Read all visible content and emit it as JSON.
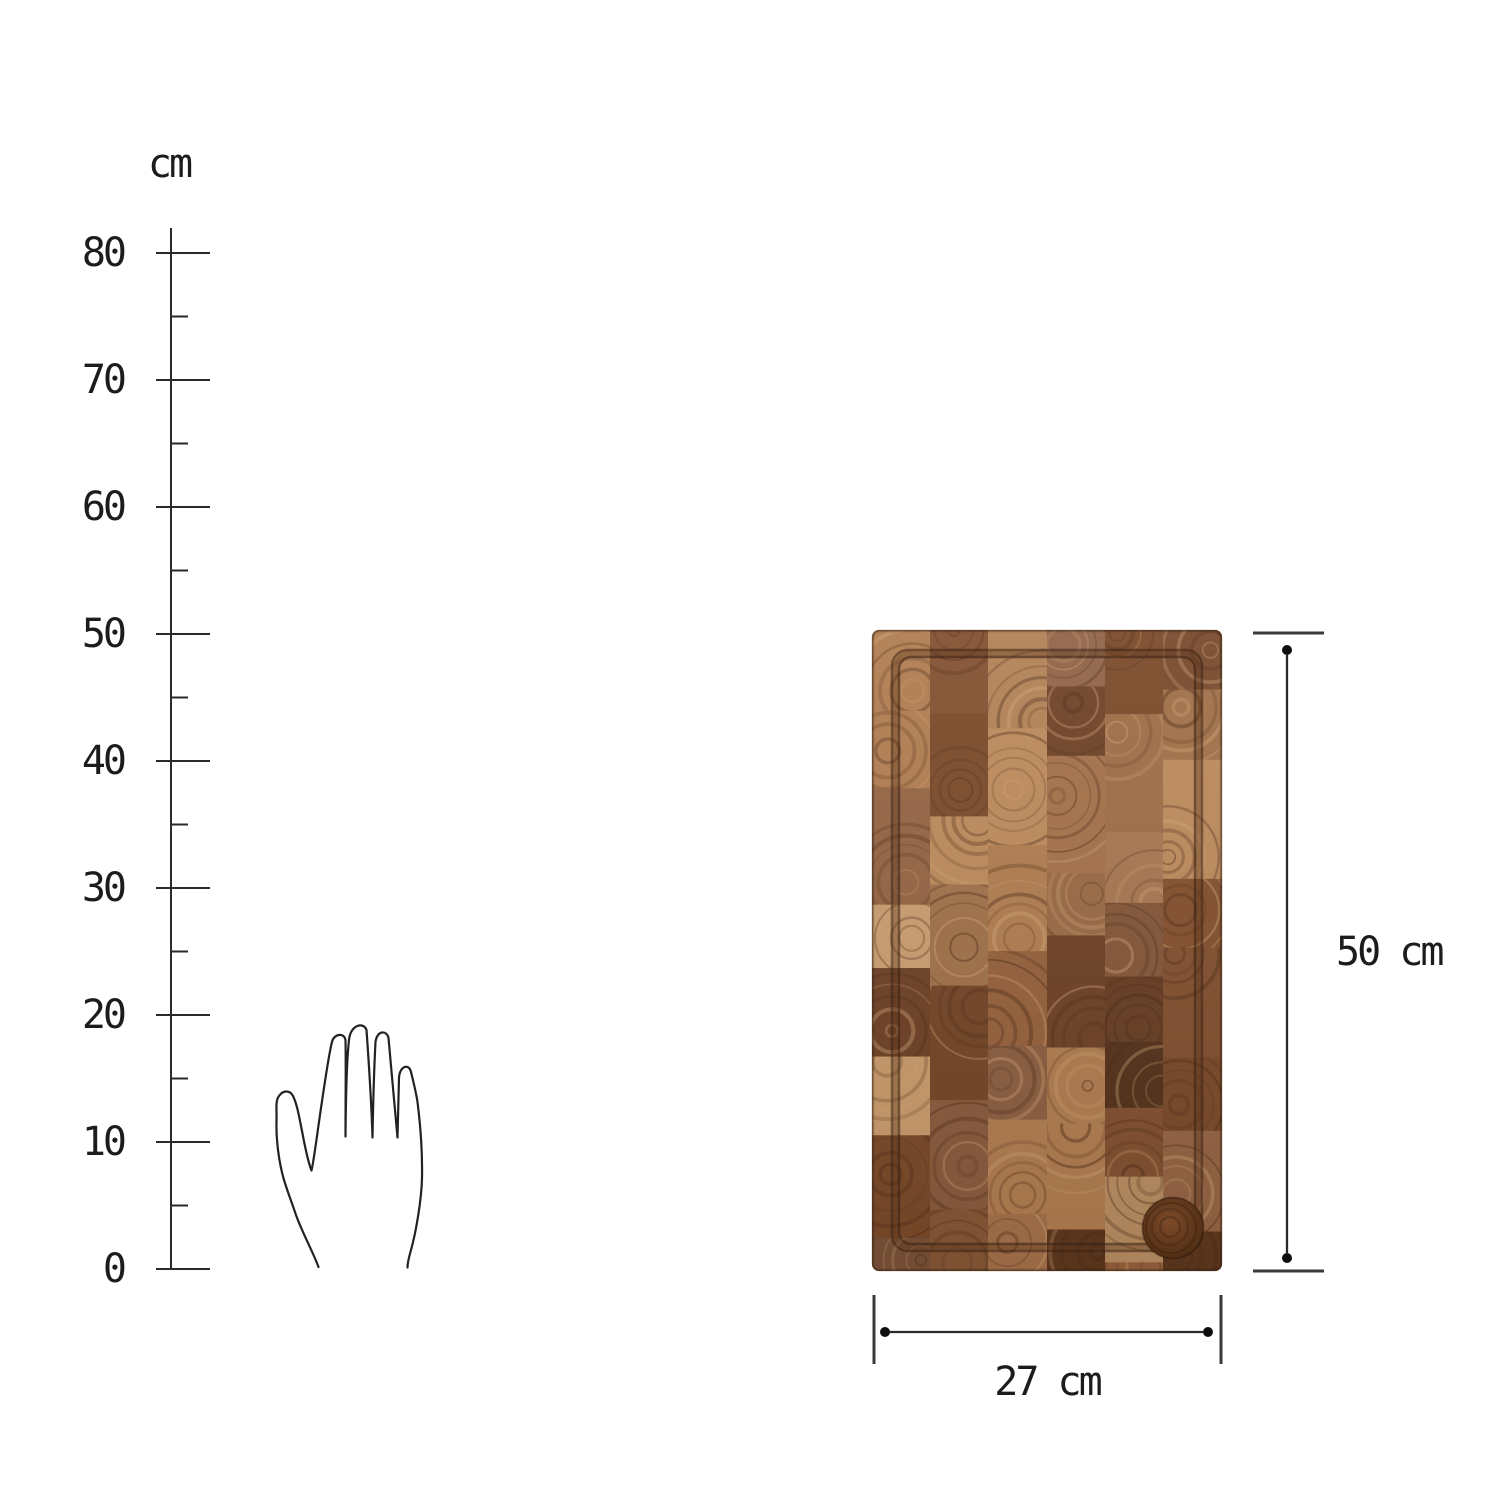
{
  "ruler": {
    "unit_label": "cm",
    "tick_labels": [
      "80",
      "70",
      "60",
      "50",
      "40",
      "30",
      "20",
      "10",
      "0"
    ]
  },
  "annotations": {
    "height_label": "50 cm",
    "width_label": "27 cm"
  },
  "icons": {
    "hand": "hand-scale-icon"
  },
  "colors": {
    "background": "#ffffff",
    "line": "#2a2a2a",
    "cap_line": "#3a3a3a",
    "dot": "#0d0d0d",
    "text": "#1c1c1c",
    "wood_base": "#8a5636",
    "wood_palette": [
      "#6e4226",
      "#7b4a2a",
      "#8a5431",
      "#96613c",
      "#a4714a",
      "#b07c50",
      "#bd8a5c",
      "#c89a6b",
      "#825030",
      "#5f381f"
    ],
    "wood_ring_dark": "#4e2c16",
    "wood_ring_light": "#d4a878",
    "groove": "#3a2112",
    "well_center": "#7d4b2a",
    "well_edge": "#46280f"
  }
}
